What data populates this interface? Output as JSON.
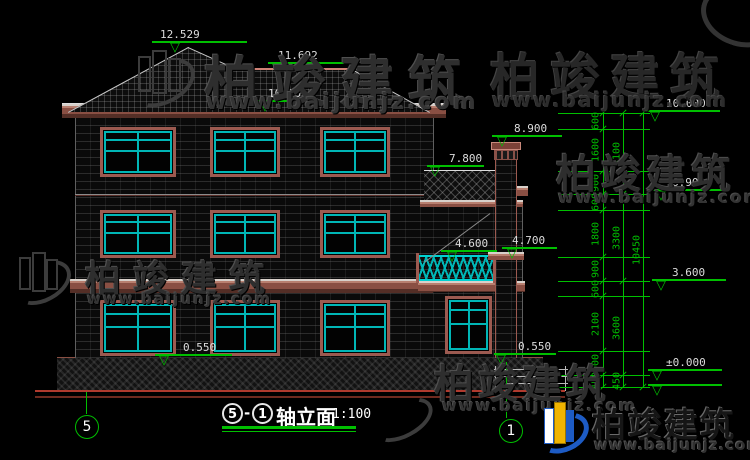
{
  "watermark": {
    "brand_cn": "柏竣建筑",
    "brand_url": "www.baijunjz.com"
  },
  "title": {
    "axis_start": "5",
    "dash": "-",
    "axis_end": "1",
    "name": "轴立面",
    "scale": "1:100"
  },
  "axis": {
    "left_bubble": "5",
    "right_bubble": "1"
  },
  "markers": {
    "peak": "12.529",
    "ridge": "11.692",
    "eave": "10.50",
    "wall_top": "10.000",
    "chimney": "8.900",
    "wing_roof": "7.800",
    "floor3": "6.900",
    "balcony": "4.600",
    "balcony_ledge": "4.700",
    "floor2": "3.600",
    "sill_left": "0.550",
    "sill_right": "0.550",
    "ground": "±0.000"
  },
  "dimensions": {
    "col1": [
      "600",
      "1600",
      "900",
      "600",
      "1800",
      "900",
      "600",
      "2100",
      "900",
      "450"
    ],
    "col2": [
      "3100",
      "3300",
      "3600",
      "450"
    ],
    "col3": [
      "10450"
    ]
  },
  "colors": {
    "dimension_green": "#00bf00",
    "trim_brown": "#9c5a50",
    "window_cyan": "#00b6b6",
    "ground_red": "#b03a2e",
    "text_white": "#dcdcdc",
    "brand_blue": "#1d5bc4",
    "brand_yellow": "#f0b400"
  }
}
